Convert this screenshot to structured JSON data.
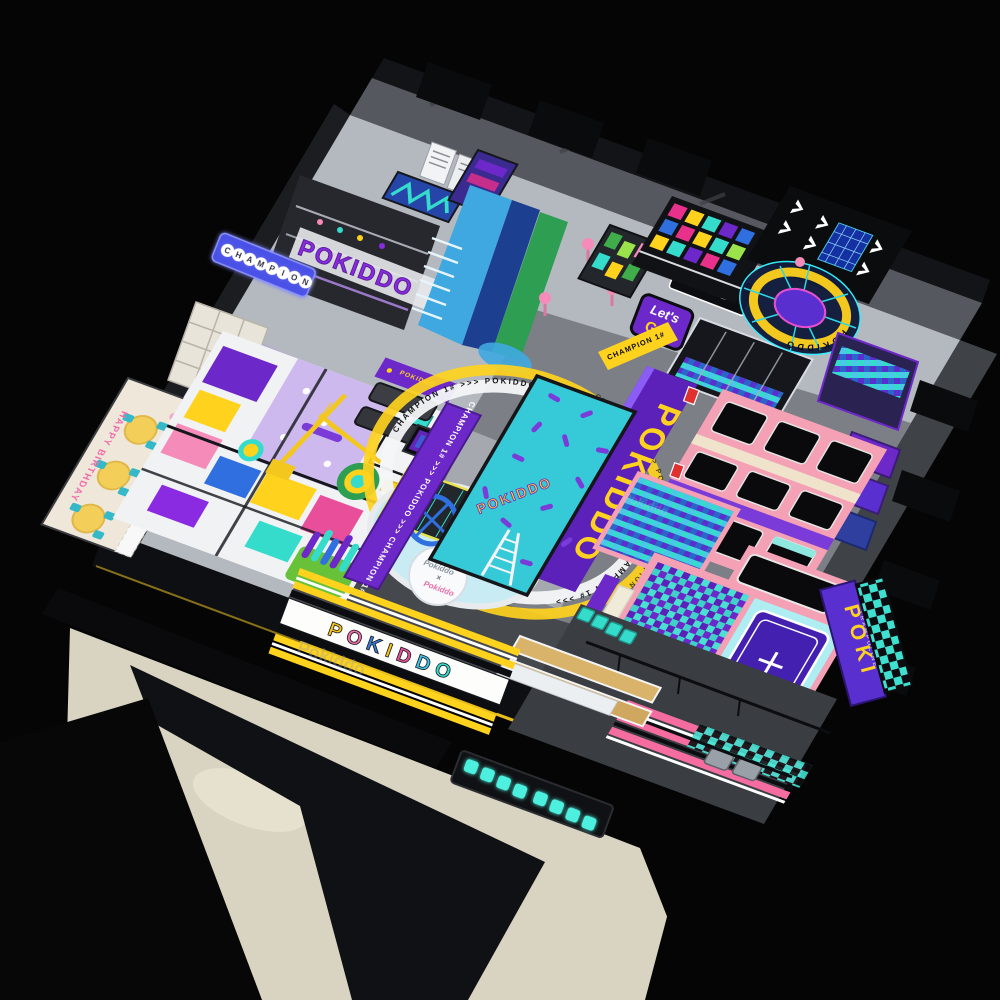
{
  "scene": {
    "description": "Aerial 3D render of an indoor trampoline and adventure park",
    "brand": "POKIDDO"
  },
  "watermark": {
    "primary": "Pokiddo",
    "secondary": "Pokiddo"
  },
  "banners": {
    "champion_letters": [
      "C",
      "H",
      "A",
      "M",
      "P",
      "I",
      "O",
      "N"
    ],
    "scores_line1": "SCORES",
    "scores_line2": "SCORES",
    "wall_letters": "POKIDDO"
  },
  "party_room": {
    "wall_text": "HAPPY BIRTHDAY"
  },
  "entrance": {
    "letters": [
      "P",
      "O",
      "K",
      "I",
      "D",
      "D",
      "O"
    ]
  },
  "tag_arena": {
    "sign": "TAG",
    "lets": "Let's",
    "go": "GO!",
    "band_text": "CHAMPION 1#"
  },
  "carousel": {
    "ring_text": "POKIDDO"
  },
  "tracks": {
    "small_text": "CHAMPION 1# >>> POKIDDO >>> CHAMPION 1#",
    "big_text": "POKIDDO",
    "ring_band_text": "CHAMPION 1# >>> POKIDDO >>> CHAMPION 1# >>> POKIDDO >>> CHAMPION 1# >>>"
  },
  "courts": {
    "tumble_text": "POKIDDO",
    "sofa_panel_text": "POKIDDO"
  },
  "side_sign": {
    "line1": "POKI",
    "line2": "TRAMPOLINE"
  },
  "center_logo": {
    "left": "Pokiddo",
    "sep": "×",
    "right": "Pokiddo"
  },
  "colors": {
    "purple": "#6d28c9",
    "violet": "#8a2be2",
    "track_purple": "#5b21b8",
    "pink_frame": "#f4a0b5",
    "hot_pink": "#f56da0",
    "magenta": "#e8318a",
    "teal": "#35dccc",
    "cyan": "#49c8e8",
    "blue": "#2f6fe0",
    "navy": "#1d3f8f",
    "yellow": "#ffd21e",
    "green": "#2e9e53",
    "lime": "#9be34a",
    "black": "#0a0b0d",
    "wall_gray": "#55585e",
    "floor_gray": "#b4b8bf",
    "beige": "#d9d3c2",
    "wood": "#d9b36a",
    "red": "#e03030",
    "glow_teal": "#4ef0df"
  }
}
